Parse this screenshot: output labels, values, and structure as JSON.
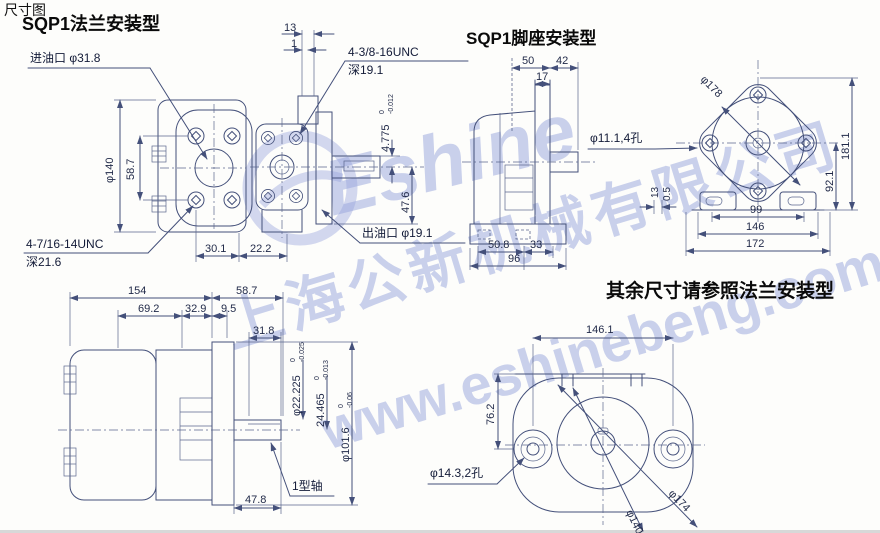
{
  "page": {
    "label": "尺寸图"
  },
  "watermark": {
    "logo_text": "Eshine",
    "company": "上海公新机械有限公司",
    "url": "www.eshinebeng.com"
  },
  "flange": {
    "title": "SQP1法兰安装型",
    "inlet": "进油口 φ31.8",
    "thread_top": "4-3/8-16UNC",
    "thread_top_depth": "深19.1",
    "thread_bottom": "4-7/16-14UNC",
    "thread_bottom_depth": "深21.6",
    "outlet": "出油口 φ19.1",
    "dims": {
      "w13": "13",
      "w1": "1",
      "dia140": "φ140",
      "h58_7": "58.7",
      "w30_1": "30.1",
      "w22_2": "22.2",
      "key": "4.775",
      "key_tol_t": "0",
      "key_tol_b": "-0.012",
      "h47_6": "47.6"
    }
  },
  "side": {
    "shaft_label": "1型轴",
    "dims": {
      "w154": "154",
      "w58_7": "58.7",
      "w69_2": "69.2",
      "w32_9": "32.9",
      "w9_5": "9.5",
      "w31_8": "31.8",
      "shaft": "φ22.225",
      "shaft_tol_t": "0",
      "shaft_tol_b": "-0.025",
      "key": "24.465",
      "key_tol_t": "0",
      "key_tol_b": "-0.013",
      "pilot": "φ101.6",
      "pilot_tol_t": "0",
      "pilot_tol_b": "-0.06",
      "w47_8": "47.8"
    }
  },
  "foot": {
    "title": "SQP1脚座安装型",
    "note": "其余尺寸请参照法兰安装型",
    "hole4": "φ11.1,4孔",
    "dims": {
      "w50": "50",
      "w42": "42",
      "w17": "17",
      "w50_8": "50.8",
      "w33": "33",
      "w96": "96",
      "dia178": "φ178",
      "h181_1": "181.1",
      "h92_1": "92.1",
      "s13": "13",
      "s0_5": "0.5",
      "w99": "99",
      "w146": "146",
      "w172": "172"
    }
  },
  "foot_front": {
    "hole2": "φ14.3,2孔",
    "dims": {
      "w146_1": "146.1",
      "h76_2": "76.2",
      "dia140": "φ140",
      "dia174": "φ174"
    }
  }
}
